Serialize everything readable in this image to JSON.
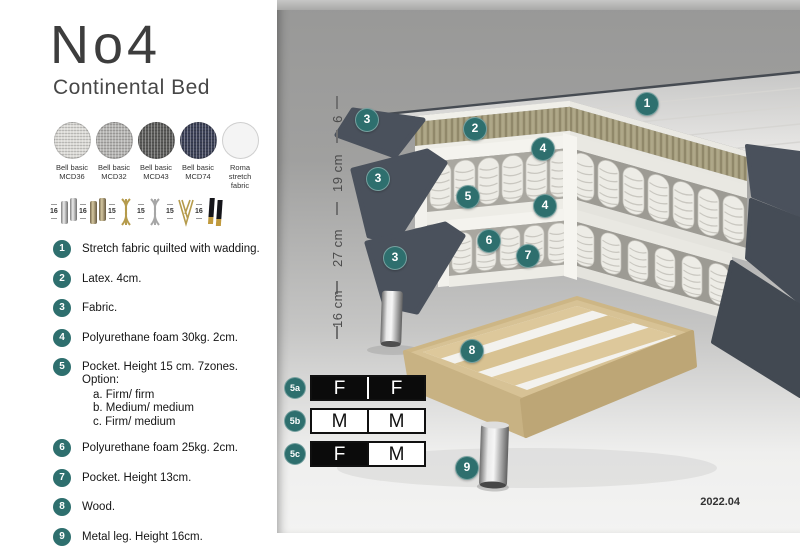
{
  "colors": {
    "accent": "#2E6F6E",
    "fabric": "#4A515C",
    "wood": "#D7C295"
  },
  "header": {
    "title": "No4",
    "subtitle": "Continental Bed"
  },
  "swatches": [
    {
      "line1": "Bell basic",
      "line2": "MCD36",
      "color": "#DBDAD6"
    },
    {
      "line1": "Bell basic",
      "line2": "MCD32",
      "color": "#B5B4B2"
    },
    {
      "line1": "Bell basic",
      "line2": "MCD43",
      "color": "#5C5C5A"
    },
    {
      "line1": "Bell basic",
      "line2": "MCD74",
      "color": "#3C4157"
    },
    {
      "line1": "Roma",
      "line2": "stretch fabric",
      "color": "#F4F4F4"
    }
  ],
  "legs": [
    {
      "size": "16"
    },
    {
      "size": "16"
    },
    {
      "size": "15"
    },
    {
      "size": "15"
    },
    {
      "size": "15"
    },
    {
      "size": "16"
    }
  ],
  "features": [
    {
      "num": "1",
      "text": "Stretch fabric quilted with wadding."
    },
    {
      "num": "2",
      "text": "Latex. 4cm."
    },
    {
      "num": "3",
      "text": "Fabric."
    },
    {
      "num": "4",
      "text": "Polyurethane foam 30kg. 2cm."
    },
    {
      "num": "5",
      "text": "Pocket. Height 15 cm. 7zones. Option:",
      "options": [
        "a. Firm/ firm",
        "b. Medium/ medium",
        "c. Firm/ medium"
      ]
    },
    {
      "num": "6",
      "text": "Polyurethane foam 25kg. 2cm."
    },
    {
      "num": "7",
      "text": "Pocket. Height 13cm."
    },
    {
      "num": "8",
      "text": "Wood."
    },
    {
      "num": "9",
      "text": "Metal leg. Height 16cm."
    }
  ],
  "diagram": {
    "callouts": [
      "1",
      "2",
      "3",
      "3",
      "3",
      "4",
      "4",
      "5",
      "6",
      "7",
      "8",
      "9"
    ],
    "dimensions": [
      "6",
      "19 cm",
      "27 cm",
      "16 cm"
    ],
    "firmness": [
      {
        "label": "5a",
        "cells": [
          {
            "text": "F"
          },
          {
            "text": "F"
          }
        ]
      },
      {
        "label": "5b",
        "cells": [
          {
            "text": "M"
          },
          {
            "text": "M"
          }
        ]
      },
      {
        "label": "5c",
        "cells": [
          {
            "text": "F"
          },
          {
            "text": "M"
          }
        ]
      }
    ],
    "version": "2022.04"
  }
}
